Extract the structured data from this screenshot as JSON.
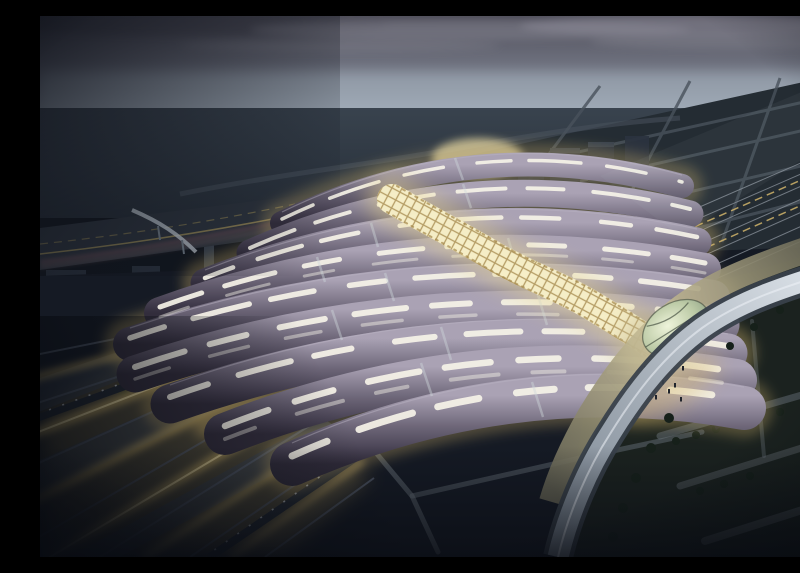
{
  "scene": {
    "subject": "aerial-dusk-rendering-wave-roof-railway-station",
    "elements": [
      "dusk-sky",
      "cloud-bank",
      "horizon-glow",
      "distant-countryside",
      "distant-town-lights",
      "field-grid",
      "city-blocks",
      "ring-road",
      "light-trail-road",
      "footbridge",
      "left-track-fan",
      "platforms",
      "trains",
      "station-roof-strips",
      "roof-skylights",
      "glass-lattice-spine",
      "central-glow-dome",
      "leaf-glass-dome",
      "entry-plaza",
      "pedestrians",
      "elevated-ramp",
      "trees",
      "riverside-park",
      "park-paths"
    ],
    "palette": {
      "sky_top": "#4e4d59",
      "sky_mid": "#6e717e",
      "sky_horizon": "#a9b6c2",
      "cloud": "#8f8e9a",
      "cloud_dark": "#474752",
      "land_far": "#39434e",
      "land_near": "#252d37",
      "field": "#242c33",
      "field_road": "#49525c",
      "city_block": "#2b333f",
      "city_block_top": "#3a434f",
      "town_light": "#b9c1c9",
      "roof_top": "#aaa2b4",
      "roof_mid": "#6e6779",
      "roof_low": "#453f50",
      "roof_edge": "#322d3c",
      "roof_rim": "#b9b2c2",
      "skylight": "#f6f3e8",
      "gap_glow": "#d9ba6c",
      "spine_core": "#f7efc8",
      "spine_glow": "#ecd98e",
      "lattice": "#a5894d",
      "dome_core": "#eef4da",
      "dome_glass": "#bccaa6",
      "dome_rim": "#84987f",
      "dome_vein": "#3f4a3c",
      "glow_dome": "#ddd0a0",
      "plaza_light": "#c7bd96",
      "plaza_dark": "#6c6a58",
      "people": "#20242c",
      "track_gold": "#dcbd6e",
      "track_gold_core": "#f1dfa4",
      "track_gray": "#596273",
      "platform": "#3c4656",
      "train": "#242a34",
      "train_window": "#cfd6dd",
      "rail_thin": "#8d959e",
      "ramp_light": "#e2e8ee",
      "ramp_mid": "#7d8894",
      "ramp_edge": "#39414b",
      "park": "#1b221f",
      "path": "#6d757e",
      "tree": "#16201a",
      "ground_navy": "#151a24",
      "night": "#070a10",
      "trail_pink": "#9b5f66",
      "trail_rose": "#c08a83",
      "lane_yellow": "#a89558",
      "bridge": "#b9c2cb",
      "facade_dark": "#20252d",
      "connector": "#cfd8dc"
    }
  }
}
